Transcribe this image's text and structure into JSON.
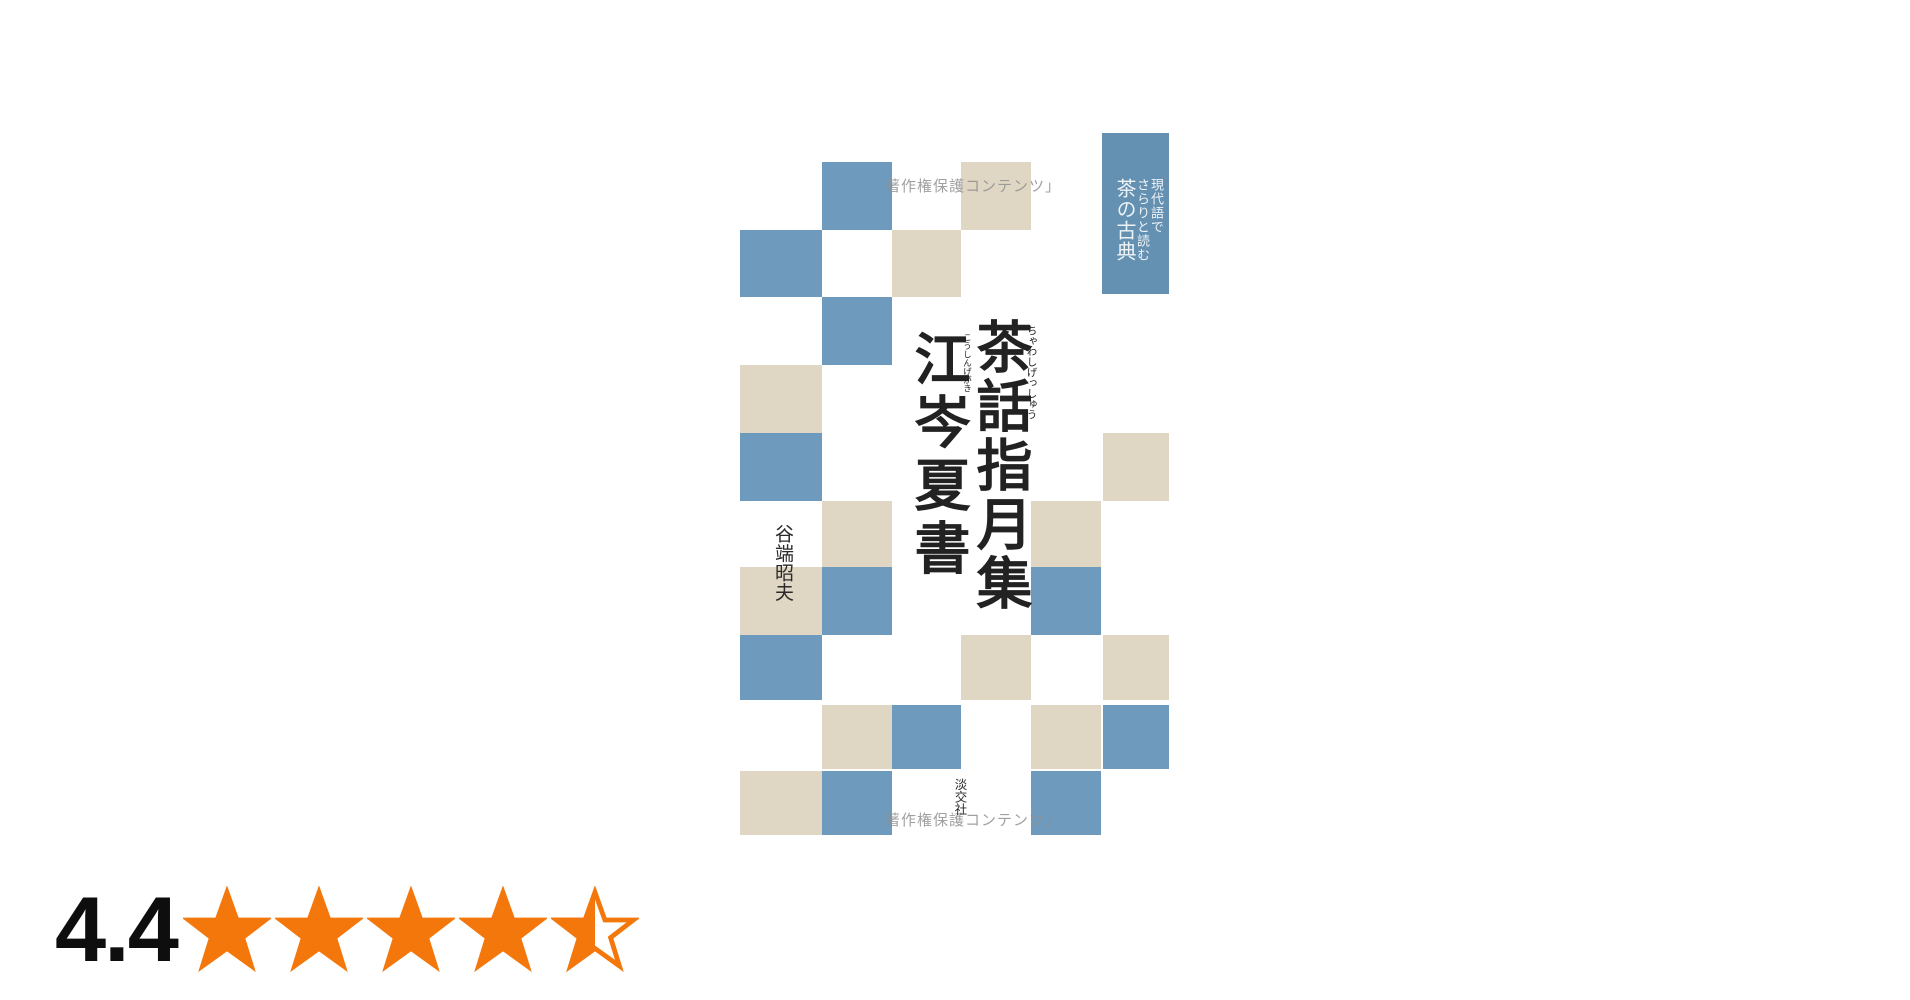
{
  "page": {
    "background": "#ffffff"
  },
  "book_cover": {
    "watermark_top": "著作権保護コンテンツ」",
    "watermark_bottom": "著作権保護コンテンツ」",
    "watermark_color": "#909090",
    "corner_label": {
      "lines": [
        "現代語で",
        "さらりと読む",
        "茶の古典"
      ],
      "bg_color": "#6490b2",
      "text_color": "#eef3f6"
    },
    "title": {
      "line1": "茶話指月集",
      "line1_furigana": "ちゃわしげっしゅう",
      "line2": "江岑夏書",
      "line2_furigana": "こうしんげがき",
      "color": "#222222"
    },
    "author": "谷端昭夫",
    "publisher": "淡交社",
    "text_color": "#2a2a2a",
    "checkerboard": {
      "colors": {
        "blue": "#6d9abd",
        "beige": "#dfd7c4"
      },
      "squares": [
        {
          "x": 82,
          "y": 29,
          "w": 70,
          "h": 68,
          "c": "blue"
        },
        {
          "x": 221,
          "y": 29,
          "w": 70,
          "h": 68,
          "c": "beige"
        },
        {
          "x": 0,
          "y": 97,
          "w": 82,
          "h": 67,
          "c": "blue"
        },
        {
          "x": 152,
          "y": 97,
          "w": 69,
          "h": 67,
          "c": "beige"
        },
        {
          "x": 82,
          "y": 164,
          "w": 70,
          "h": 68,
          "c": "blue"
        },
        {
          "x": 0,
          "y": 232,
          "w": 82,
          "h": 68,
          "c": "beige"
        },
        {
          "x": 0,
          "y": 300,
          "w": 82,
          "h": 68,
          "c": "blue"
        },
        {
          "x": 363,
          "y": 300,
          "w": 66,
          "h": 68,
          "c": "beige"
        },
        {
          "x": 82,
          "y": 368,
          "w": 70,
          "h": 66,
          "c": "beige"
        },
        {
          "x": 291,
          "y": 368,
          "w": 70,
          "h": 66,
          "c": "beige"
        },
        {
          "x": 0,
          "y": 434,
          "w": 82,
          "h": 68,
          "c": "beige"
        },
        {
          "x": 82,
          "y": 434,
          "w": 70,
          "h": 68,
          "c": "blue"
        },
        {
          "x": 291,
          "y": 434,
          "w": 70,
          "h": 68,
          "c": "blue"
        },
        {
          "x": 0,
          "y": 502,
          "w": 82,
          "h": 65,
          "c": "blue"
        },
        {
          "x": 221,
          "y": 502,
          "w": 70,
          "h": 65,
          "c": "beige"
        },
        {
          "x": 363,
          "y": 502,
          "w": 66,
          "h": 65,
          "c": "beige"
        },
        {
          "x": 82,
          "y": 572,
          "w": 70,
          "h": 64,
          "c": "beige"
        },
        {
          "x": 152,
          "y": 572,
          "w": 69,
          "h": 64,
          "c": "blue"
        },
        {
          "x": 291,
          "y": 572,
          "w": 70,
          "h": 64,
          "c": "beige"
        },
        {
          "x": 363,
          "y": 572,
          "w": 66,
          "h": 64,
          "c": "blue"
        },
        {
          "x": 0,
          "y": 638,
          "w": 82,
          "h": 64,
          "c": "beige"
        },
        {
          "x": 82,
          "y": 638,
          "w": 70,
          "h": 64,
          "c": "blue"
        },
        {
          "x": 291,
          "y": 638,
          "w": 70,
          "h": 64,
          "c": "blue"
        }
      ]
    }
  },
  "rating": {
    "value": "4.4",
    "stars": [
      1,
      1,
      1,
      1,
      0.5
    ],
    "star_color": "#f3770b",
    "text_color": "#0e0e0e"
  }
}
